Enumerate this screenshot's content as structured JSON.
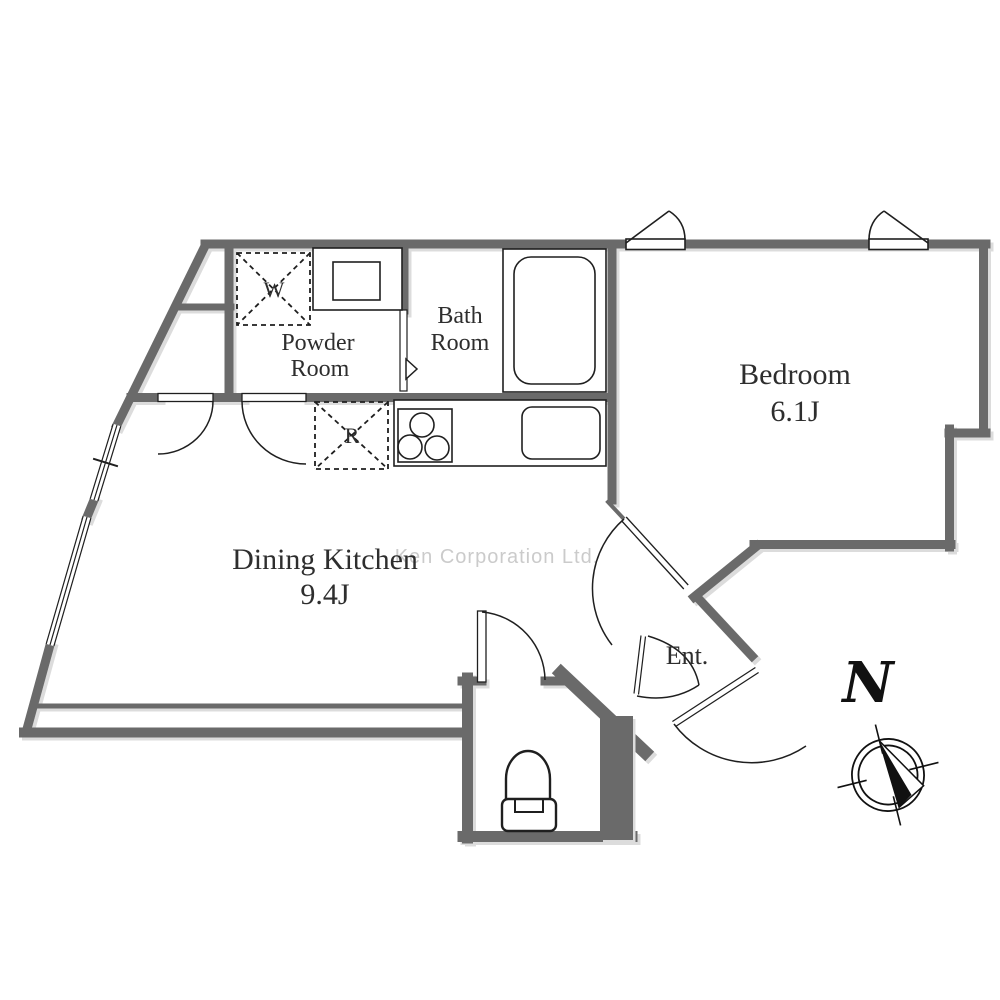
{
  "plan": {
    "rooms": {
      "bedroom": {
        "name": "Bedroom",
        "size": "6.1J"
      },
      "dining_kitchen": {
        "name": "Dining Kitchen",
        "size": "9.4J"
      },
      "bath": {
        "line1": "Bath",
        "line2": "Room"
      },
      "powder": {
        "line1": "Powder",
        "line2": "Room"
      },
      "entrance": {
        "label": "Ent."
      }
    },
    "appliances": {
      "washer_mark": "W",
      "refrigerator_mark": "R"
    },
    "compass": {
      "north_label": "N"
    },
    "watermark": {
      "text": "Ken Corporation Ltd."
    },
    "colors": {
      "wall": "#6a6a6a",
      "line": "#1f1f1f",
      "label": "#2e2e2e",
      "watermark": "#cbcbcb",
      "shadow": "#dcdcdc"
    }
  }
}
